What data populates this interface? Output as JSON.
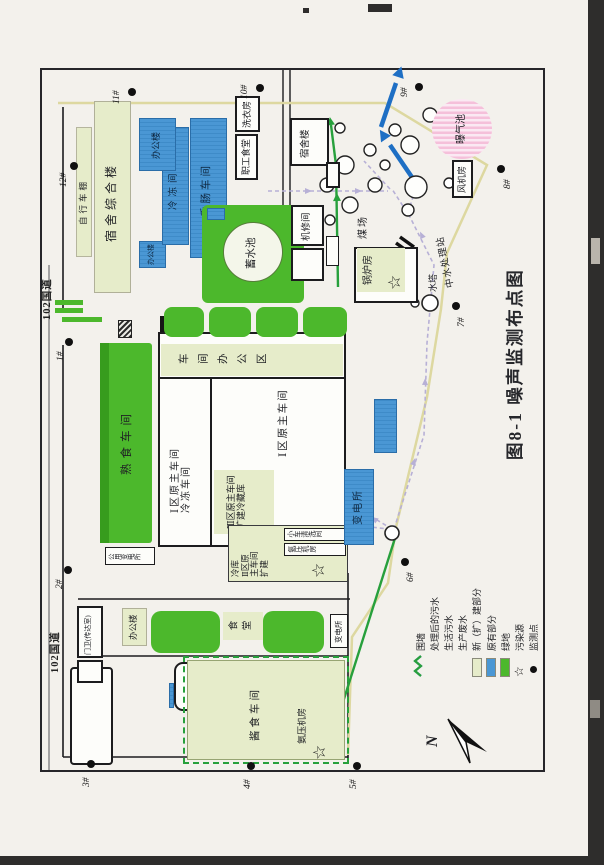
{
  "title": "图8-1  噪声监测布点图",
  "roads": {
    "highway_a": "102国道",
    "highway_b": "102国道"
  },
  "compass": {
    "label": "N"
  },
  "monitor_points": [
    "1#",
    "2#",
    "3#",
    "4#",
    "5#",
    "6#",
    "7#",
    "8#",
    "9#",
    "10#",
    "11#",
    "12#"
  ],
  "legend": [
    {
      "label": "围墙",
      "symbol": "zigzag",
      "color": "#ddd8a0"
    },
    {
      "label": "处理后的污水",
      "symbol": "zigzag",
      "color": "#2e6fbe"
    },
    {
      "label": "生活污水",
      "symbol": "zigzag",
      "color": "#c3bedd"
    },
    {
      "label": "生产废水",
      "symbol": "zigzag",
      "color": "#27a03c"
    },
    {
      "label": "新（扩）建部分",
      "symbol": "box",
      "color": "#e6ecca"
    },
    {
      "label": "原有部分",
      "symbol": "box",
      "color": "#4a97d4"
    },
    {
      "label": "绿地",
      "symbol": "box",
      "color": "#4cb82c"
    },
    {
      "label": "污染源",
      "symbol": "star",
      "color": "#161616"
    },
    {
      "label": "监测点",
      "symbol": "dot",
      "color": "#101010"
    }
  ],
  "buildings": {
    "bicycle_shed": "自行车棚",
    "dorm_complex": "宿舍综合楼",
    "office_a": "办公楼",
    "cold_room": "冷冻间",
    "sausage": "香肠车间",
    "office_b": "办公楼",
    "canteen_staff": "职工食堂",
    "laundry": "洗衣房",
    "dorm": "宿舍楼",
    "reservoir": "蓄水池",
    "cooked_food": "熟食车间",
    "public_substation": "公用变电所",
    "workshop_office": "车间办公区",
    "zone1": "Ⅰ区原主车间\n冷冻车间",
    "zone1b": "Ⅰ区原主车间",
    "zone3": "Ⅲ区原主车间\n扩建冷藏库",
    "zone2": "冷库\nⅡ区原\n主车间\n扩建",
    "car_wash": "小车清洗间",
    "ammonia_mid": "氨压机房",
    "substation_blue": "变电所",
    "machine_repair": "机修间",
    "coal_yard": "煤场",
    "boiler": "锅炉房",
    "water_tower": "水塔",
    "reclaimed_station": "中水处理站",
    "fan_room": "风机房",
    "aeration": "曝气池",
    "gatehouse": "门卫(传达室)",
    "office_c": "办公楼",
    "canteen": "食堂",
    "substation_c": "变电所",
    "sauce": "酱食车间",
    "ammonia_b": "氨压机房",
    "star_symbol": "☆"
  },
  "colors": {
    "green_area": "#4cb82c",
    "new_build": "#e6ecca",
    "original_part": "#4a97d4",
    "aeration_pink": "#f3bcd9",
    "wall_line": "#ddd8a0",
    "treated_sewage": "#2e6fbe",
    "domestic_sewage": "#c3bedd",
    "production_wastewater": "#27a03c",
    "paper": "#f3f1ec"
  }
}
